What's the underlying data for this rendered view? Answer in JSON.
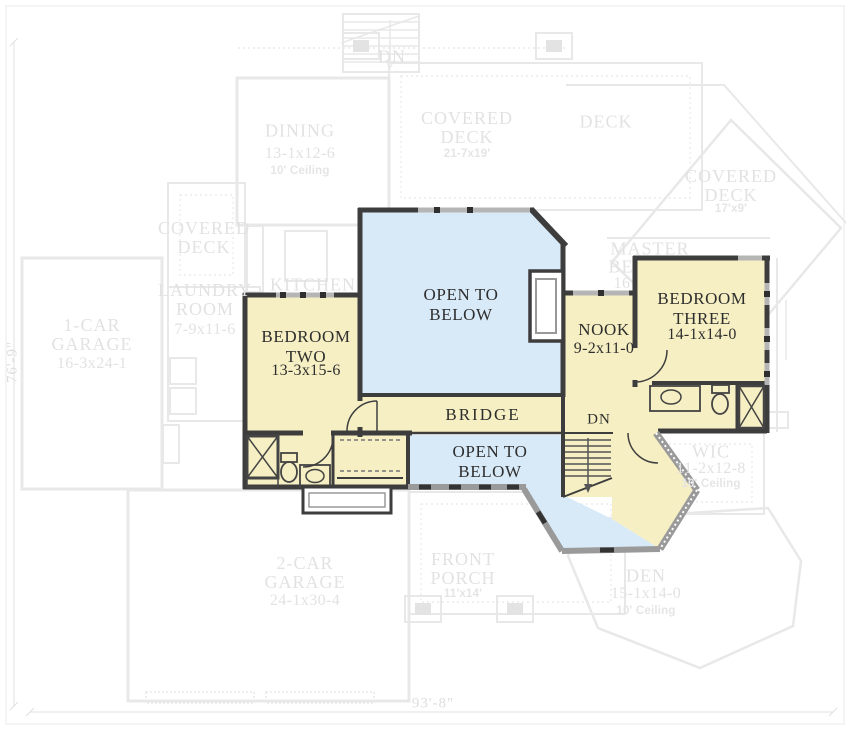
{
  "palette": {
    "room_fill": "#f6efc3",
    "open_fill": "#d8eaf8",
    "wall": "#3d3d3d",
    "gray_wall": "#9a9a9a",
    "ghost_line": "#e6e6e6",
    "ghost_text": "#e2e2e2"
  },
  "upper_level": {
    "bedroom_two": {
      "name": "BEDROOM\nTWO",
      "dims": "13-3x15-6"
    },
    "bedroom_three": {
      "name": "BEDROOM\nTHREE",
      "dims": "14-1x14-0"
    },
    "nook": {
      "name": "NOOK",
      "dims": "9-2x11-0"
    },
    "bridge": {
      "name": "BRIDGE"
    },
    "open_to_below_main": {
      "name": "OPEN TO\nBELOW"
    },
    "open_to_below_lower": {
      "name": "OPEN TO\nBELOW"
    },
    "stairs": {
      "label": "DN"
    }
  },
  "ghost_level": {
    "dining": {
      "name": "DINING",
      "dims": "13-1x12-6",
      "ceiling": "10' Ceiling"
    },
    "covered_deck_top": {
      "name": "COVERED\nDECK",
      "dims": "21-7x19'"
    },
    "deck": {
      "name": "DECK"
    },
    "covered_deck_right": {
      "name": "COVERED\nDECK",
      "dims": "17'x9'"
    },
    "covered_deck_left": {
      "name": "COVERED\nDECK"
    },
    "master_bedroom": {
      "line1": "MASTER",
      "line2": "BE",
      "line3": "16"
    },
    "kitchen": {
      "name": "KITCHEN"
    },
    "laundry": {
      "name": "LAUNDRY\nROOM",
      "dims": "7-9x11-6"
    },
    "garage_one": {
      "name": "1-CAR\nGARAGE",
      "dims": "16-3x24-1"
    },
    "garage_two": {
      "name": "2-CAR\nGARAGE",
      "dims": "24-1x30-4"
    },
    "front_porch": {
      "name": "FRONT\nPORCH",
      "dims": "11'x14'"
    },
    "den": {
      "name": "DEN",
      "dims": "15-1x14-0",
      "ceiling": "10' Ceiling"
    },
    "wic": {
      "name": "WIC",
      "dims": "11-2x12-8",
      "ceiling": "10' Ceiling"
    },
    "stairs": {
      "label": "DN"
    }
  },
  "dimensions": {
    "overall_width": "93'-8\"",
    "overall_depth": "76'-9\""
  }
}
